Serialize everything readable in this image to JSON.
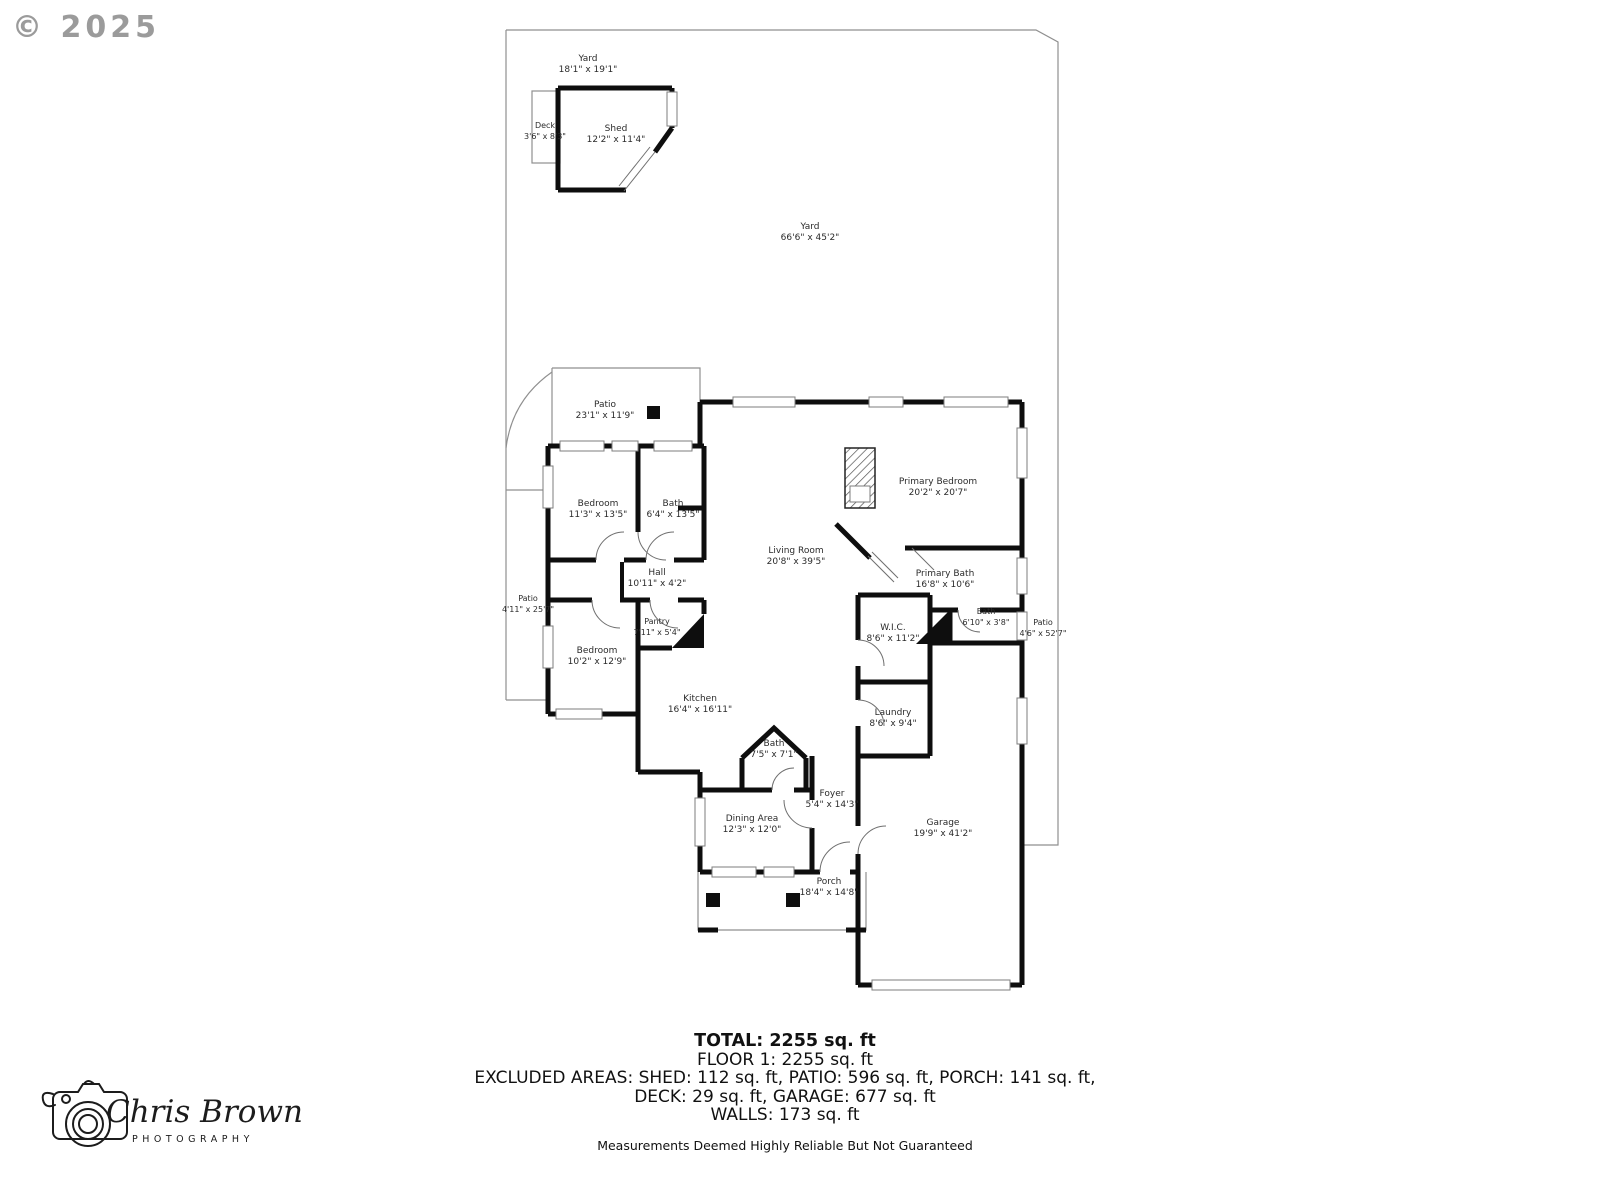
{
  "watermark": "© 2025",
  "rooms": {
    "yard_upper": {
      "name": "Yard",
      "dims": "18'1\" x 19'1\""
    },
    "deck": {
      "name": "Deck",
      "dims": "3'6\" x 8'3\""
    },
    "shed": {
      "name": "Shed",
      "dims": "12'2\" x 11'4\""
    },
    "yard_main": {
      "name": "Yard",
      "dims": "66'6\" x 45'2\""
    },
    "patio_top": {
      "name": "Patio",
      "dims": "23'1\" x 11'9\""
    },
    "bedroom1": {
      "name": "Bedroom",
      "dims": "11'3\" x 13'5\""
    },
    "bath1": {
      "name": "Bath",
      "dims": "6'4\" x 13'5\""
    },
    "hall": {
      "name": "Hall",
      "dims": "10'11\" x 4'2\""
    },
    "patio_left": {
      "name": "Patio",
      "dims": "4'11\" x 25'7\""
    },
    "pantry": {
      "name": "Pantry",
      "dims": "7'11\" x 5'4\""
    },
    "bedroom2": {
      "name": "Bedroom",
      "dims": "10'2\" x 12'9\""
    },
    "living": {
      "name": "Living Room",
      "dims": "20'8\" x 39'5\""
    },
    "primary_bedroom": {
      "name": "Primary Bedroom",
      "dims": "20'2\" x 20'7\""
    },
    "primary_bath": {
      "name": "Primary Bath",
      "dims": "16'8\" x 10'6\""
    },
    "bath_small": {
      "name": "Bath",
      "dims": "6'10\" x 3'8\""
    },
    "patio_right": {
      "name": "Patio",
      "dims": "4'6\" x 52'7\""
    },
    "wic": {
      "name": "W.I.C.",
      "dims": "8'6\" x 11'2\""
    },
    "laundry": {
      "name": "Laundry",
      "dims": "8'6\" x 9'4\""
    },
    "kitchen": {
      "name": "Kitchen",
      "dims": "16'4\" x 16'11\""
    },
    "bath_hall": {
      "name": "Bath",
      "dims": "7'5\" x 7'1\""
    },
    "foyer": {
      "name": "Foyer",
      "dims": "5'4\" x 14'3\""
    },
    "dining": {
      "name": "Dining Area",
      "dims": "12'3\" x 12'0\""
    },
    "porch": {
      "name": "Porch",
      "dims": "18'4\" x 14'8\""
    },
    "garage": {
      "name": "Garage",
      "dims": "19'9\" x 41'2\""
    }
  },
  "summary": {
    "total": "TOTAL: 2255 sq. ft",
    "floor1": "FLOOR 1: 2255 sq. ft",
    "excluded_line1": "EXCLUDED AREAS: SHED: 112 sq. ft, PATIO: 596 sq. ft, PORCH: 141 sq. ft,",
    "excluded_line2": "DECK: 29 sq. ft, GARAGE: 677 sq. ft",
    "walls": "WALLS: 173 sq. ft",
    "disclaimer": "Measurements Deemed Highly Reliable But Not Guaranteed"
  },
  "logo": {
    "name": "Chris Brown",
    "subtitle": "PHOTOGRAPHY",
    "icon": "camera-sketch-icon"
  },
  "colors": {
    "walls": "#0e0e0e",
    "thin_lines": "#8f8f8f",
    "label_text": "#2b2b2b",
    "watermark": "#9b9b9b",
    "background": "#ffffff"
  }
}
